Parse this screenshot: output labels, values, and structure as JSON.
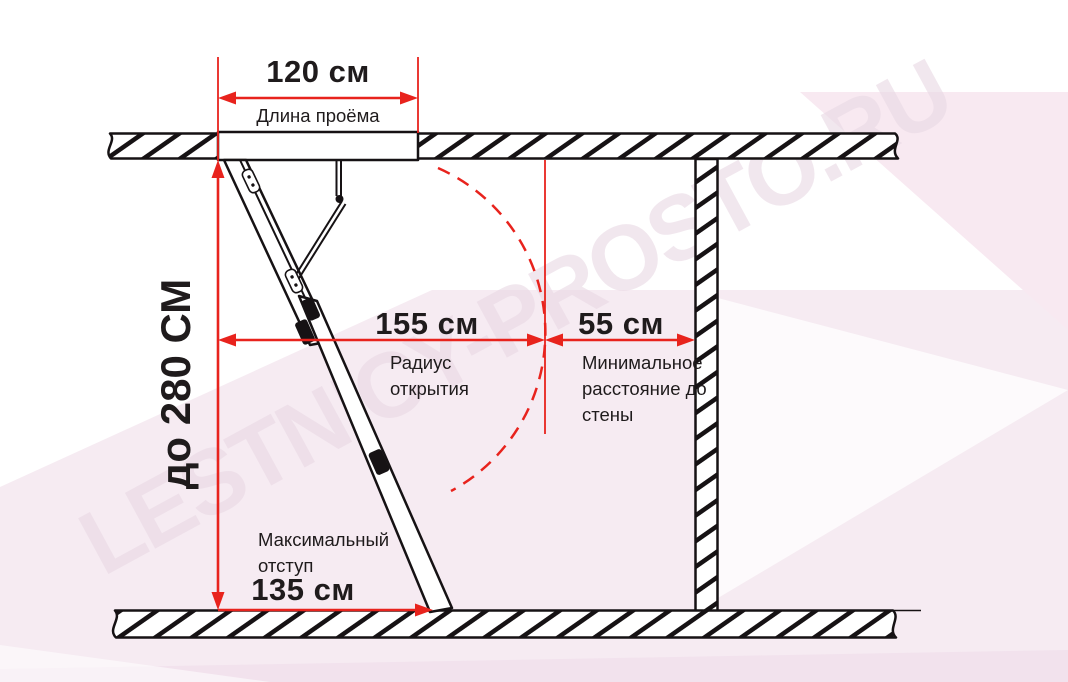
{
  "colors": {
    "red": "#e8231d",
    "ink": "#1f1b1c",
    "paper": "#ffffff",
    "pink": "#f6ebf2",
    "pink2": "#f8e9f1",
    "watermark": "#e9d9e4"
  },
  "watermark": {
    "text": "LESTNICY-PROSTO.RU"
  },
  "dimensions": {
    "opening": {
      "value": "120 см",
      "label": "Длина проёма"
    },
    "height": {
      "value": "до 280 СМ"
    },
    "radius": {
      "value": "155 см",
      "label": "Радиус открытия"
    },
    "wall": {
      "value": "55 см",
      "label": "Минимальное расстояние до стены"
    },
    "offset": {
      "value": "135 см",
      "label": "Максимальный отступ"
    }
  }
}
